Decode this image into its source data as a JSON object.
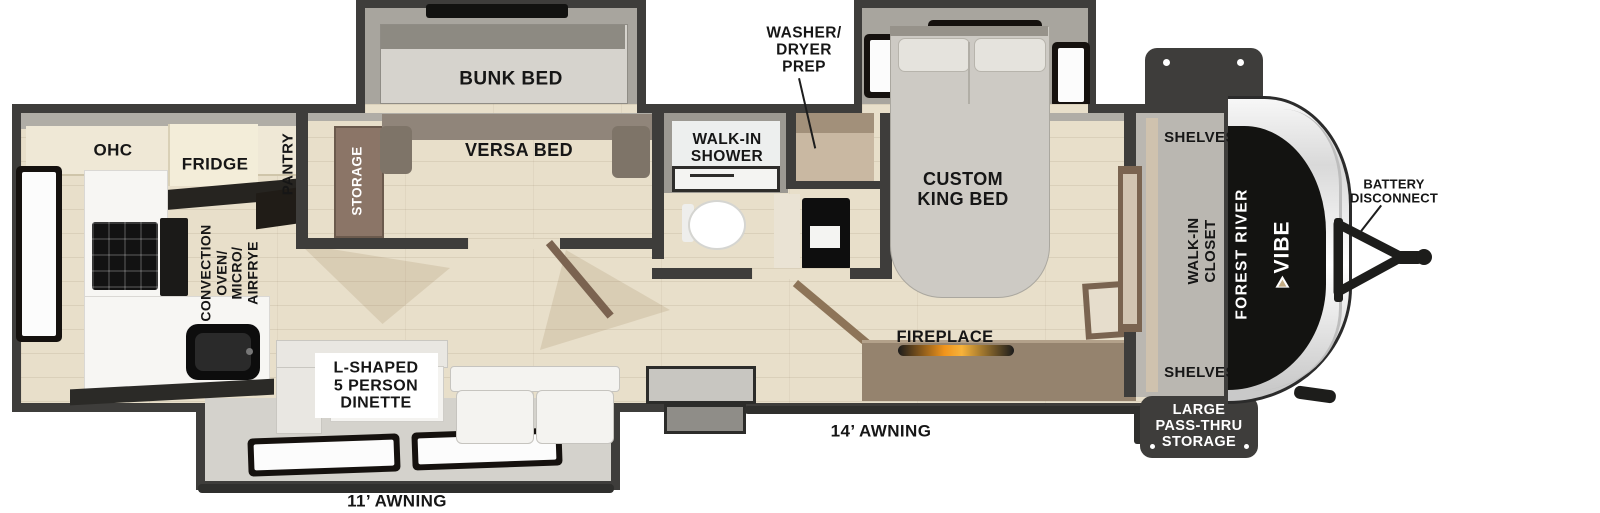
{
  "meta": {
    "type": "rv-floorplan",
    "brand": "FOREST RIVER",
    "model": "VIBE"
  },
  "labels": {
    "ohc": "OHC",
    "fridge": "FRIDGE",
    "pantry": "PANTRY",
    "convection": "CONVECTION\nOVEN/\nMICRO/\nAIRFRYE",
    "storage": "STORAGE",
    "bunk_bed": "BUNK BED",
    "versa_bed": "VERSA BED",
    "walk_in_shower": "WALK-IN\nSHOWER",
    "washer_dryer_prep": "WASHER/\nDRYER\nPREP",
    "custom_king_bed": "CUSTOM\nKING BED",
    "fireplace": "FIREPLACE",
    "shelves_top": "SHELVES",
    "shelves_bottom": "SHELVES",
    "walk_in_closet": "WALK-IN\nCLOSET",
    "large_pass_thru_storage": "LARGE\nPASS-THRU\nSTORAGE",
    "battery_disconnect": "BATTERY\nDISCONNECT",
    "dinette": "L-SHAPED\n5 PERSON\nDINETTE",
    "awning_14": "14’ AWNING",
    "awning_11": "11’ AWNING"
  },
  "colors": {
    "wall": "#3e3d3b",
    "floor_wood": "#e8dfca",
    "slide_floor": "#d4d2cc",
    "cabinet_cream": "#efe8d6",
    "counter_marble": "#f7f6f3",
    "appliance_dark": "#141412",
    "wood_brown": "#8a7464",
    "flame_accent": "#f0941c",
    "badge_bg": "#3e3d3b",
    "badge_text": "#ffffff",
    "label_text": "#161616"
  }
}
